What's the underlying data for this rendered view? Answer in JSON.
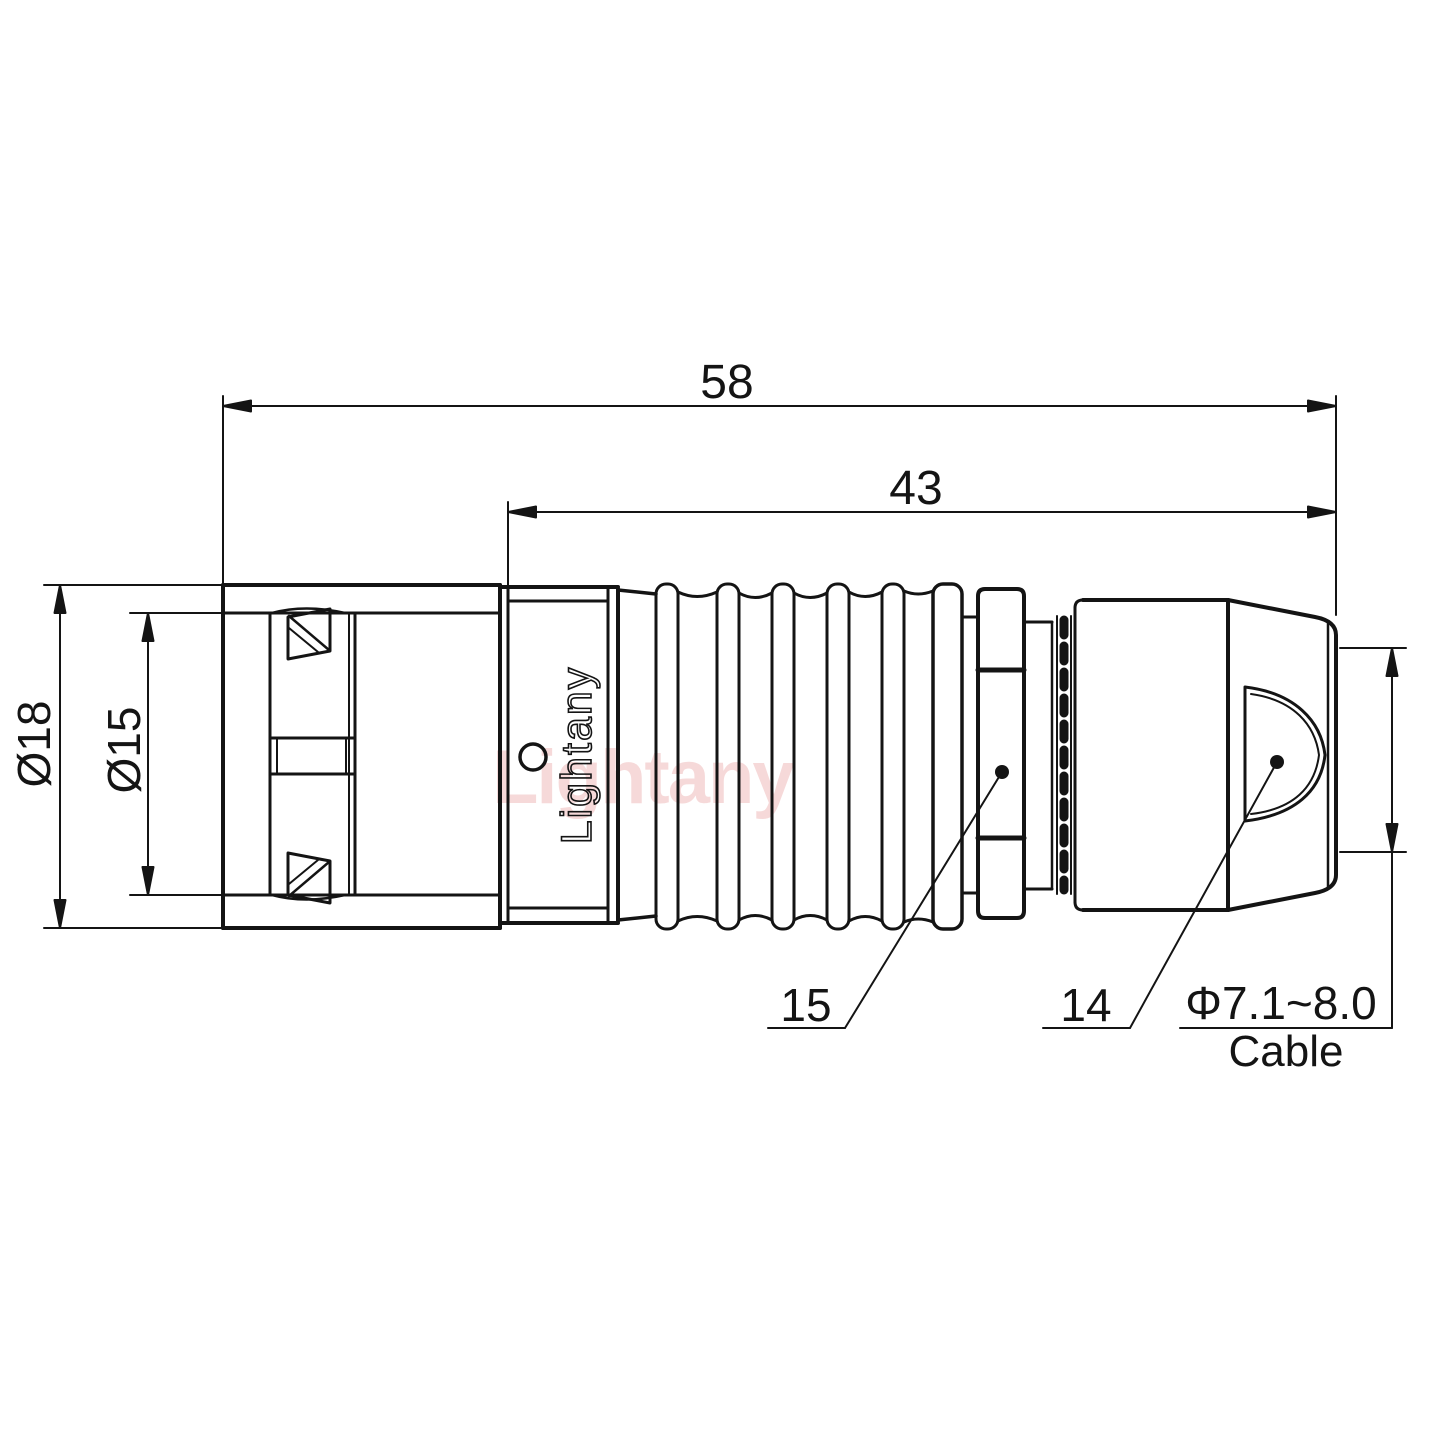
{
  "drawing": {
    "brand": "Lightany",
    "watermark": "Lightany",
    "dimensions": {
      "overall_length": "58",
      "body_length": "43",
      "outer_diameter": "Ø18",
      "inner_diameter": "Ø15",
      "cable_range": "Φ7.1~8.0",
      "cable_label": "Cable"
    },
    "callouts": {
      "coupling_nut": "15",
      "strain_relief": "14"
    },
    "colors": {
      "line": "#141414",
      "watermark": "#e89c9c",
      "background": "#ffffff"
    }
  }
}
